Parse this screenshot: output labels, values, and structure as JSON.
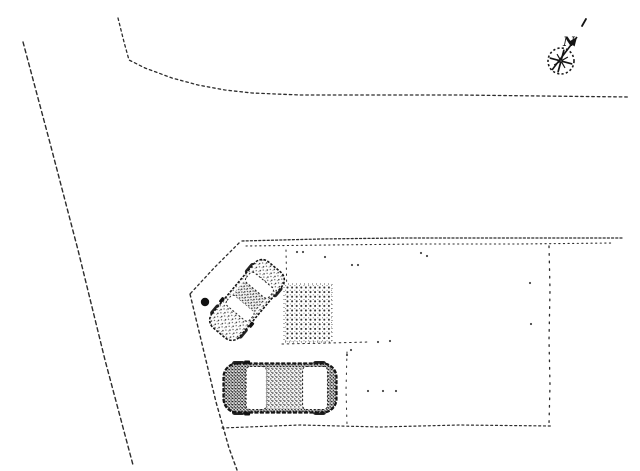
{
  "drawing": {
    "type": "site-plan-pencil-sketch",
    "background": "#ffffff",
    "ink": "#1a1a1a",
    "compass": {
      "label": "N",
      "cx": 561,
      "cy": 61,
      "r": 13,
      "spoke_count": 8,
      "spoke_offset_deg": 15,
      "arrow": {
        "x1": 552,
        "y1": 70,
        "x2": 577,
        "y2": 37
      },
      "tick": {
        "x1": 582,
        "y1": 26,
        "x2": 586,
        "y2": 19
      },
      "label_pos": {
        "x": 563,
        "y": 46
      }
    },
    "boundary_lines": [
      {
        "id": "road-west-edge",
        "points": [
          [
            23,
            42
          ],
          [
            50,
            143
          ],
          [
            78,
            250
          ],
          [
            105,
            360
          ],
          [
            133,
            465
          ]
        ],
        "dash": "4 3.2",
        "w": 1.4
      },
      {
        "id": "north-boundary",
        "points": [
          [
            118,
            18
          ],
          [
            124,
            42
          ],
          [
            129,
            60
          ],
          [
            145,
            68
          ],
          [
            172,
            78
          ],
          [
            198,
            85
          ],
          [
            225,
            90
          ],
          [
            252,
            93
          ],
          [
            300,
            95
          ],
          [
            380,
            95
          ],
          [
            460,
            95
          ],
          [
            540,
            96
          ],
          [
            630,
            97
          ]
        ],
        "dash": "2.5 3",
        "w": 1.3
      },
      {
        "id": "plot-top-edge-outer",
        "points": [
          [
            242,
            241
          ],
          [
            320,
            239
          ],
          [
            400,
            238
          ],
          [
            480,
            238
          ],
          [
            560,
            238
          ],
          [
            622,
            238
          ]
        ],
        "dash": "2 2.2",
        "w": 1.3
      },
      {
        "id": "plot-top-edge-inner",
        "points": [
          [
            246,
            246
          ],
          [
            330,
            245
          ],
          [
            420,
            244
          ],
          [
            520,
            244
          ],
          [
            612,
            243
          ]
        ],
        "dash": "1.2 3.4",
        "w": 1.1
      },
      {
        "id": "plot-chamfer-edge",
        "points": [
          [
            239,
            243
          ],
          [
            214,
            268
          ],
          [
            190,
            294
          ]
        ],
        "dash": "2.2 3",
        "w": 1.3
      },
      {
        "id": "road-east-edge",
        "points": [
          [
            190,
            294
          ],
          [
            203,
            348
          ],
          [
            216,
            402
          ],
          [
            229,
            448
          ],
          [
            237,
            470
          ]
        ],
        "dash": "3 3.2",
        "w": 1.4
      },
      {
        "id": "plot-bottom-edge",
        "points": [
          [
            222,
            428
          ],
          [
            300,
            425
          ],
          [
            380,
            427
          ],
          [
            460,
            425
          ],
          [
            551,
            426
          ]
        ],
        "dash": "2 2.8",
        "w": 1.2
      },
      {
        "id": "plot-right-edge",
        "points": [
          [
            549,
            246
          ],
          [
            550,
            290
          ],
          [
            549,
            340
          ],
          [
            550,
            385
          ],
          [
            549,
            424
          ]
        ],
        "dash": "1.6 6",
        "w": 1.3
      },
      {
        "id": "approach-left-edge",
        "points": [
          [
            286,
            250
          ],
          [
            287,
            300
          ],
          [
            286,
            345
          ]
        ],
        "dash": "1.4 4.6",
        "w": 1.0
      },
      {
        "id": "approach-bottom-edge",
        "points": [
          [
            282,
            344
          ],
          [
            330,
            343
          ],
          [
            368,
            342
          ]
        ],
        "dash": "1.6 3.6",
        "w": 1.0
      },
      {
        "id": "terrace-left-edge",
        "points": [
          [
            347,
            352
          ],
          [
            346,
            390
          ],
          [
            347,
            424
          ]
        ],
        "dash": "1.5 5.5",
        "w": 1.0
      }
    ],
    "stray_dots": [
      [
        297,
        252
      ],
      [
        303,
        252
      ],
      [
        325,
        257
      ],
      [
        352,
        265
      ],
      [
        358,
        265
      ],
      [
        421,
        253
      ],
      [
        427,
        256
      ],
      [
        530,
        283
      ],
      [
        531,
        324
      ],
      [
        368,
        391
      ],
      [
        383,
        391
      ],
      [
        396,
        391
      ],
      [
        378,
        342
      ],
      [
        390,
        341
      ],
      [
        351,
        350
      ],
      [
        347,
        355
      ]
    ],
    "survey_marker": {
      "cx": 205,
      "cy": 302,
      "r": 4.2
    },
    "paved_area": {
      "x": 284,
      "y": 284,
      "width": 48,
      "height": 58
    },
    "cars": [
      {
        "id": "car-angled",
        "cx": 247,
        "cy": 300,
        "length": 86,
        "width": 36,
        "angle_deg": -50,
        "tone": "light",
        "windshield": [
          -0.2,
          -0.05
        ],
        "roof": [
          -0.05,
          0.15
        ],
        "rear_window": [
          0.15,
          0.3
        ]
      },
      {
        "id": "car-horizontal",
        "cx": 280,
        "cy": 388,
        "length": 113,
        "width": 49,
        "angle_deg": 0,
        "tone": "dark",
        "windshield": [
          -0.3,
          -0.12
        ],
        "roof": [
          -0.12,
          0.2
        ],
        "rear_window": [
          0.2,
          0.42
        ]
      }
    ]
  }
}
